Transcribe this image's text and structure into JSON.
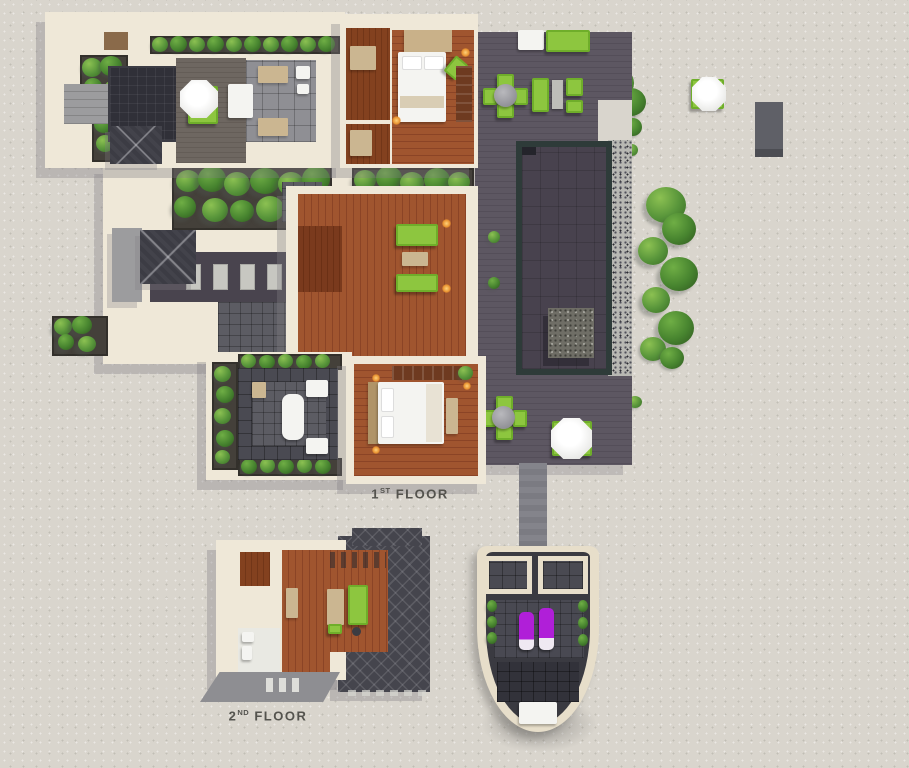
{
  "title": "Villa top-view floor plan rendering",
  "labels": {
    "floor1": {
      "number": "1",
      "ordinal": "ST",
      "word": "FLOOR"
    },
    "floor2": {
      "number": "2",
      "ordinal": "ND",
      "word": "FLOOR"
    }
  },
  "palette": {
    "sand": "#d9d5cd",
    "wall_beige": "#efe8d8",
    "deck_gray": "#58525d",
    "terrace_deck": "#6a635d",
    "pool_water": "#48424e",
    "pool_coping": "#2e3b39",
    "gravel": "#b8b8b3",
    "wood_floor": "#9a5230",
    "wood_floor_dark": "#7c3d22",
    "furniture_green": "#8dc63f",
    "plant_green": "#57943a",
    "white_furniture": "#f4f4f1",
    "tan_furniture": "#cbb691",
    "roof_dark": "#45454d",
    "stone_block": "#6f6e66",
    "purple_lounger": "#b01fd8",
    "label_text": "#54534e"
  }
}
